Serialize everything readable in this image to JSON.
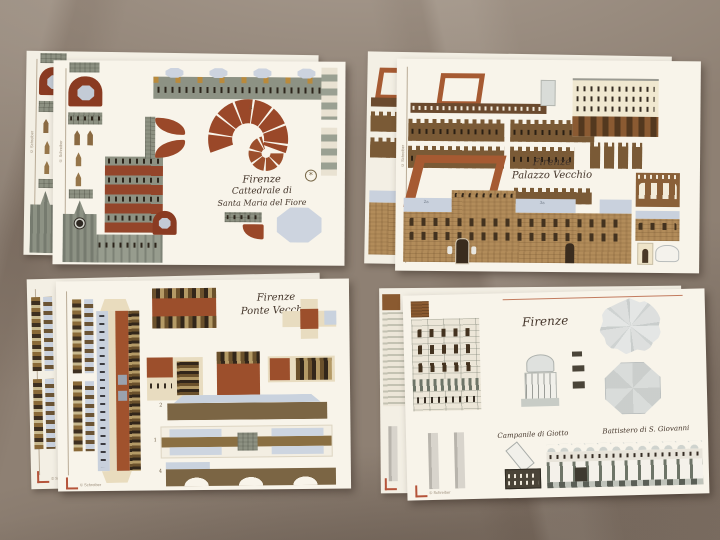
{
  "colors": {
    "fabric": "#8e8073",
    "card": "#f8f4ea",
    "brick_red": "#9a4829",
    "roof_red": "#9c4f2c",
    "stone_grey_green": "#8d9182",
    "tan_wall": "#b28c5a",
    "crenel_brown": "#7a5a36",
    "blue_grey": "#c9d1dd",
    "cream_building": "#f0e8d0",
    "dark_window": "#3e2f20",
    "title_ink": "#44352a",
    "red_rule": "#b5543a",
    "light_grey": "#d9dbd8"
  },
  "sheets": {
    "cattedrale": {
      "title_line1": "Firenze",
      "title_line2": "Cattedrale di",
      "title_line3": "Santa Maria del Fiore",
      "part_numbers": {
        "dome_spiral": "3"
      },
      "edge_mark": "© Schreiber"
    },
    "palazzo": {
      "title_line1": "Firenze",
      "title_line2": "Palazzo Vecchio",
      "part_numbers": {
        "wall_tab_left": "2a",
        "wall_tab_right": "3a"
      },
      "edge_mark": "© Schreiber"
    },
    "ponte": {
      "title_line1": "Firenze",
      "title_line2": "Ponte Vecchio",
      "part_numbers": {
        "upper_arch": "2",
        "roadway": "1",
        "lower_arch": "4"
      },
      "edge_mark": "© Schreiber"
    },
    "firenze_set": {
      "title": "Firenze",
      "campanile_caption": "Campanile di Giotto",
      "battistero_caption": "Battistero di S. Giovanni",
      "edge_mark": "© Schreiber"
    }
  }
}
